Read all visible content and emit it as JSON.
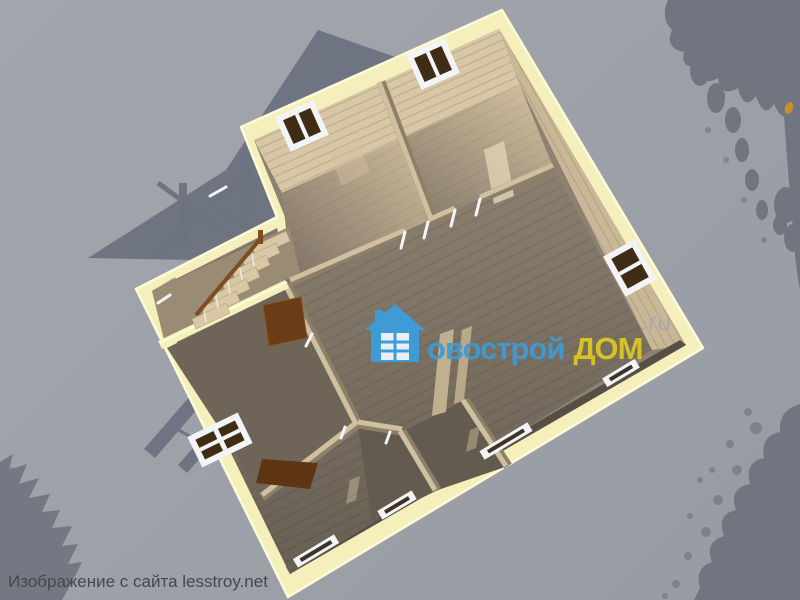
{
  "scene": {
    "description": "3D isometric cutaway render of a wooden house floor plan seen from above, on a grey backdrop with cast shadows of roof gables, a stair railing and trees",
    "house": {
      "wall_top_color": "#f5f0bb",
      "rooms": [
        {
          "name": "bedroom-top-left",
          "window": "top-left wall"
        },
        {
          "name": "bedroom-top-right",
          "window": "top-left wall"
        },
        {
          "name": "living-room-center",
          "windows": "right wall and bottom wall"
        },
        {
          "name": "room-lower-left",
          "window": "left wall"
        },
        {
          "name": "small-room-bottom-a",
          "window": "bottom wall"
        },
        {
          "name": "small-room-bottom-b",
          "window": "bottom wall"
        },
        {
          "name": "stair-annex-left",
          "feature": "wooden staircase with brown handrail"
        }
      ],
      "windows_count": 8,
      "doors": [
        "open brown door from stair annex",
        "open brown door near lower-left room"
      ],
      "floor_material": "wood planks",
      "walls_material": "timber"
    },
    "background_objects": [
      "house-and-gable-shadow-upper-left",
      "stair-railing-shadow-left",
      "tree-silhouette-top-right-with-trunk",
      "tree-silhouette-bottom-right",
      "tree-silhouette-bottom-left",
      "small-orange-leaf-on-trunk"
    ]
  },
  "watermark": {
    "icon": "house-logo-icon",
    "text_main": "овострой",
    "text_accent": "ДОМ",
    "text_suffix": ".ru"
  },
  "caption": {
    "text": "Изображение с сайта lesstroy.net"
  },
  "colors": {
    "bg1": "#a3a6ad",
    "bg2": "#979ba3",
    "shadow": "#6d7280",
    "tree": "#70757f",
    "wallYellow": "#f5f0bb",
    "wallYellowBright": "#fdfbd8",
    "woodLight": "#d7c7a7",
    "woodMid": "#c9b897",
    "woodDark": "#b1a083",
    "floorLight": "#cfbe9e",
    "floorMid": "#8d8171",
    "floorDark": "#6e6558",
    "floorDarker": "#635b4f",
    "streak": "#c9b795",
    "windowFrame": "#f3f4f6",
    "windowSash": "#3f2c15",
    "doorBrown": "#6b3c16",
    "doorBrownDark": "#5e3513",
    "railBrown": "#7d4e22",
    "tread": "#d8c8a6",
    "leaf": "#c98f2e",
    "wmBlue": "#3e9bd5",
    "wmYellow": "#ddc81e",
    "wmGray": "#a6aab1",
    "caption": "#45484d"
  }
}
